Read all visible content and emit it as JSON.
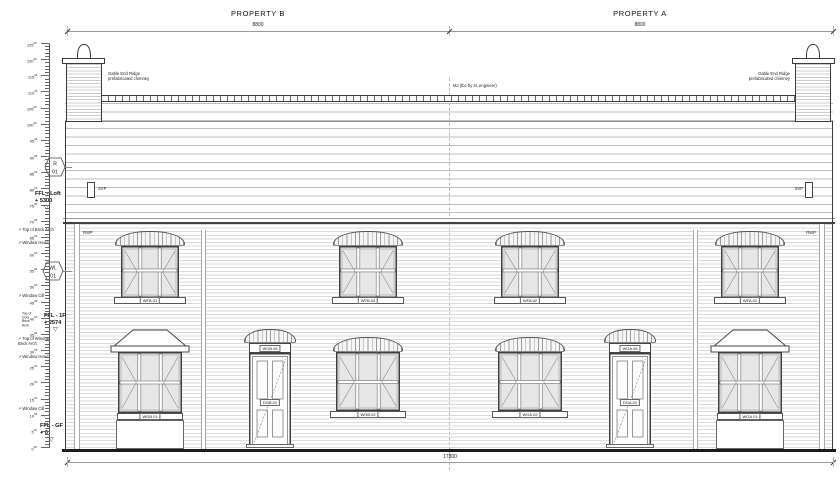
{
  "titles": {
    "property_b": "PROPERTY B",
    "property_a": "PROPERTY A"
  },
  "dimensions": {
    "top_left": "8800",
    "top_right": "8800",
    "bottom": "17800"
  },
  "levels": {
    "loft": {
      "label": "FFL - Loft",
      "value": "+ 5300"
    },
    "first": {
      "label": "FFL - 1F",
      "value": "+ 2574"
    },
    "ground": {
      "label": "FFL - GF",
      "value": "+ 0"
    }
  },
  "annotations": {
    "ff_top_of_brick_arch": "Top of Brick Arch",
    "ff_window_head": "Window Head",
    "ff_window_cill": "Window Cill",
    "door_arch_stack": "Top of\nDoor\nBrick\nArch",
    "gf_top_of_window_brick_arch": "Top of Window\nBrick Arch",
    "gf_window_head": "Window Head",
    "gf_window_cill": "Window Cill"
  },
  "notes": {
    "chimney_left": "Gable End Ridge\nprefabricated chimney",
    "chimney_right": "Gable End Ridge\nprefabricated chimney",
    "roof_center": "MJ (tbc by st. engineer)"
  },
  "tags": {
    "roof": {
      "line1": "R",
      "line2": "01"
    },
    "wall": {
      "line1": "WL",
      "line2": "01"
    }
  },
  "pipes": {
    "svp": "SVP",
    "rwp": "RWP"
  },
  "openings": {
    "first_floor": [
      "WFB.01",
      "WFB.02",
      "WFA.02",
      "WFA.01"
    ],
    "ground_windows": [
      "WGB.02",
      "WGA.02"
    ],
    "bays": [
      "WGB.01",
      "WGA.01"
    ],
    "doors": [
      {
        "door": "DGB.01",
        "fanlight": "WGB.05"
      },
      {
        "door": "DGA.01",
        "fanlight": "WGA.05"
      }
    ]
  },
  "scale_bar": {
    "suffix": "00",
    "labels": [
      "125",
      "120",
      "115",
      "110",
      "105",
      "100",
      "95",
      "90",
      "85",
      "80",
      "75",
      "70",
      "65",
      "60",
      "55",
      "50",
      "45",
      "40",
      "35",
      "30",
      "25",
      "20",
      "15",
      "10",
      "5",
      "0"
    ]
  }
}
